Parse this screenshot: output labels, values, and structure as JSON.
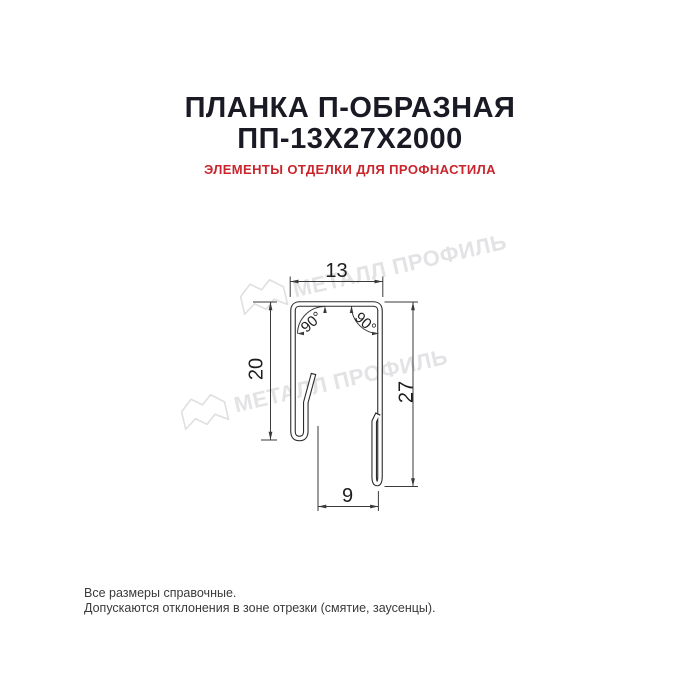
{
  "title": {
    "line1": "ПЛАНКА П-ОБРАЗНАЯ",
    "line2": "ПП-13Х27Х2000"
  },
  "subtitle": "ЭЛЕМЕНТЫ ОТДЕЛКИ ДЛЯ ПРОФНАСТИЛА",
  "watermark": {
    "text": "МЕТАЛЛ ПРОФИЛЬ",
    "logo_icon": "metall-profil-logo",
    "color": "#e3e3e6"
  },
  "drawing": {
    "type": "technical-profile-section",
    "dimensions": {
      "top_width": "13",
      "left_height": "20",
      "right_height": "27",
      "bottom_width": "9",
      "angle_left": "90°",
      "angle_right": "90°"
    },
    "line_color": "#2b2b2b"
  },
  "footer": {
    "line1": "Все размеры справочные.",
    "line2": "Допускаются отклонения в зоне отрезки (смятие, заусенцы)."
  },
  "colors": {
    "background": "#ffffff",
    "title": "#1a1a24",
    "subtitle_red": "#c9252c",
    "watermark_gray": "#e3e3e6"
  }
}
